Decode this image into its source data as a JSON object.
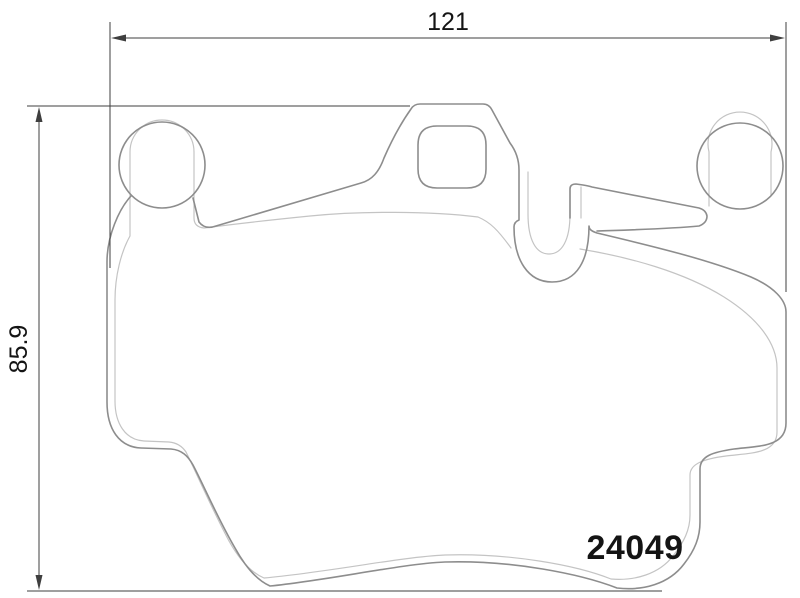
{
  "drawing": {
    "type": "brake-pad-technical-drawing",
    "part_number": "24049",
    "width_dimension": "121",
    "height_dimension": "85.9"
  },
  "colors": {
    "background": "#ffffff",
    "outer_contour": "#8d8d8d",
    "inner_contour": "#c4c4c4",
    "dimension_lines": "#3f3f3f",
    "text": "#141414"
  }
}
